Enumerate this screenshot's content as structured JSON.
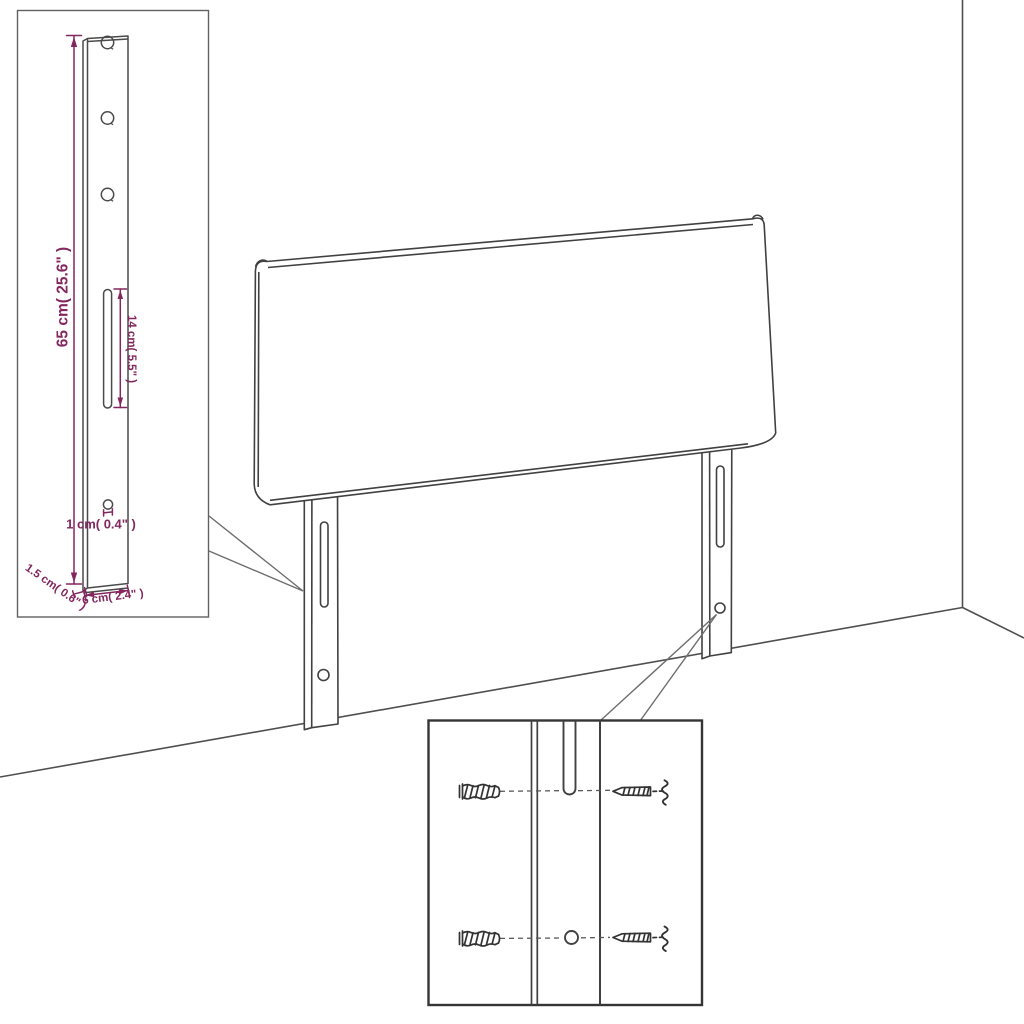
{
  "page": {
    "background_color": "#ffffff",
    "line_color": "#414141",
    "dimension_color": "#83275f"
  },
  "inset_detail": {
    "labels": {
      "bracket_height": "65 cm( 25.6\" )",
      "slot_length": "14 cm( 5.5\" )",
      "hole_diameter": "1 cm( 0.4\" )",
      "bracket_thickness": "1.5 cm( 0.6\" )",
      "bracket_width": "6 cm( 2.4\" )"
    }
  },
  "hardware_detail": {
    "icons": {
      "wall_plug": "wall-plug-icon",
      "screw": "screw-icon"
    }
  }
}
